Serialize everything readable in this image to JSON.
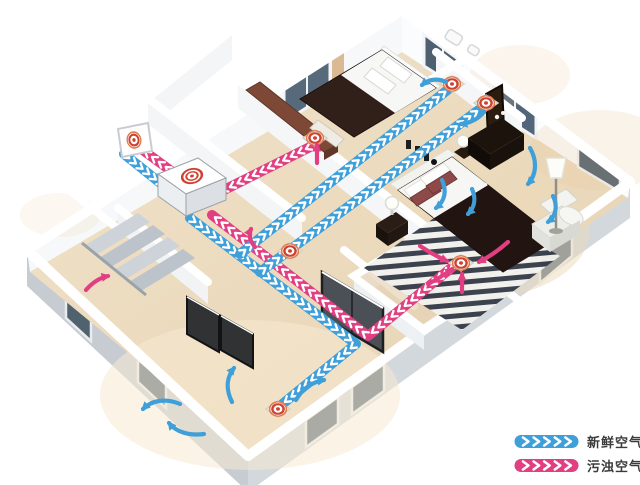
{
  "diagram_title": "home fresh-air ventilation system cutaway",
  "legend": {
    "items": [
      {
        "id": "fresh-air",
        "label": "新鲜空气",
        "color": "#3f9fd9"
      },
      {
        "id": "stale-air",
        "label": "污浊空气",
        "color": "#e23f82"
      }
    ]
  },
  "colors": {
    "fresh": "#3f9fd9",
    "stale": "#e23f82",
    "chevron": "#ffffff",
    "diffuser_ring": "#cf4130",
    "diffuser_halo": "#e07b4f",
    "label_text": "#3b3b3b"
  },
  "unit": {
    "id": "ventilation-unit",
    "kind": "heat-recovery-ventilator"
  },
  "ducts": [
    {
      "id": "stale-unit-to-outside",
      "air": "stale",
      "points": [
        [
          178,
          176
        ],
        [
          140,
          148
        ]
      ]
    },
    {
      "id": "stale-master-bedroom-return",
      "air": "stale",
      "points": [
        [
          456,
          264
        ],
        [
          368,
          336
        ],
        [
          212,
          215
        ]
      ]
    },
    {
      "id": "stale-bathroom-return",
      "air": "stale",
      "points": [
        [
          312,
          146
        ],
        [
          208,
          198
        ]
      ]
    },
    {
      "id": "fresh-outside-intake",
      "air": "fresh",
      "points": [
        [
          124,
          154
        ],
        [
          164,
          186
        ]
      ]
    },
    {
      "id": "fresh-trunk-to-living-room",
      "air": "fresh",
      "points": [
        [
          190,
          218
        ],
        [
          356,
          344
        ],
        [
          280,
          406
        ]
      ]
    },
    {
      "id": "fresh-branch-bedroom-1",
      "air": "fresh",
      "points": [
        [
          240,
          254
        ],
        [
          450,
          88
        ]
      ]
    },
    {
      "id": "fresh-branch-bedroom-2",
      "air": "fresh",
      "points": [
        [
          260,
          272
        ],
        [
          484,
          106
        ]
      ]
    }
  ],
  "vents": [
    {
      "id": "outdoor-wall-vent",
      "kind": "wall-panel",
      "x": 134,
      "y": 140
    },
    {
      "id": "supply-diffuser-bedroom-1",
      "kind": "diffuser",
      "x": 452,
      "y": 84
    },
    {
      "id": "supply-diffuser-bedroom-2",
      "kind": "diffuser",
      "x": 486,
      "y": 103
    },
    {
      "id": "supply-diffuser-hallway",
      "kind": "diffuser",
      "x": 290,
      "y": 251
    },
    {
      "id": "supply-diffuser-living-room",
      "kind": "diffuser",
      "x": 278,
      "y": 409
    },
    {
      "id": "return-grille-master-bedroom",
      "kind": "diffuser",
      "x": 461,
      "y": 263
    },
    {
      "id": "return-grille-bathroom",
      "kind": "diffuser",
      "x": 315,
      "y": 138
    }
  ],
  "flow_arrows": [
    {
      "id": "living-up",
      "air": "fresh",
      "path": "M 232,402 C 226,390 226,378 234,368"
    },
    {
      "id": "living-left",
      "air": "fresh",
      "path": "M 180,404 C 166,398 152,400 143,409"
    },
    {
      "id": "living-left-low",
      "air": "fresh",
      "path": "M 204,434 C 189,436 176,432 169,423"
    },
    {
      "id": "living-right",
      "air": "fresh",
      "path": "M 296,400 C 302,389 312,382 324,380"
    },
    {
      "id": "master-bed-1",
      "air": "fresh",
      "path": "M 442,180 C 447,191 445,201 436,208"
    },
    {
      "id": "master-bed-2",
      "air": "fresh",
      "path": "M 472,189 C 476,198 475,207 468,214"
    },
    {
      "id": "master-window",
      "air": "fresh",
      "path": "M 530,148 C 537,160 537,174 528,184"
    },
    {
      "id": "master-corner",
      "air": "fresh",
      "path": "M 553,196 C 558,206 556,216 548,222"
    },
    {
      "id": "bedroom1-supply",
      "air": "fresh",
      "path": "M 446,82 C 438,78 429,79 422,85"
    },
    {
      "id": "bedroom2-supply",
      "air": "fresh",
      "path": "M 484,112 C 478,119 470,123 461,124"
    },
    {
      "id": "staircase-up",
      "air": "stale",
      "path": "M 86,290 C 92,283 99,278 108,276"
    },
    {
      "id": "master-to-grille-l",
      "air": "stale",
      "path": "M 420,246 C 429,252 438,257 447,261"
    },
    {
      "id": "master-to-grille-r",
      "air": "stale",
      "path": "M 508,242 C 499,250 489,257 479,262"
    },
    {
      "id": "master-grille-up",
      "air": "stale",
      "path": "M 462,292 C 462,286 462,280 462,274"
    },
    {
      "id": "master-to-grille-b",
      "air": "stale",
      "path": "M 428,284 C 436,280 444,275 452,269"
    },
    {
      "id": "bathroom-grille-up",
      "air": "stale",
      "path": "M 317,163 C 317,157 317,151 317,145"
    },
    {
      "id": "hallway-curl",
      "air": "stale",
      "path": "M 255,247 C 250,241 248,235 251,229"
    }
  ]
}
